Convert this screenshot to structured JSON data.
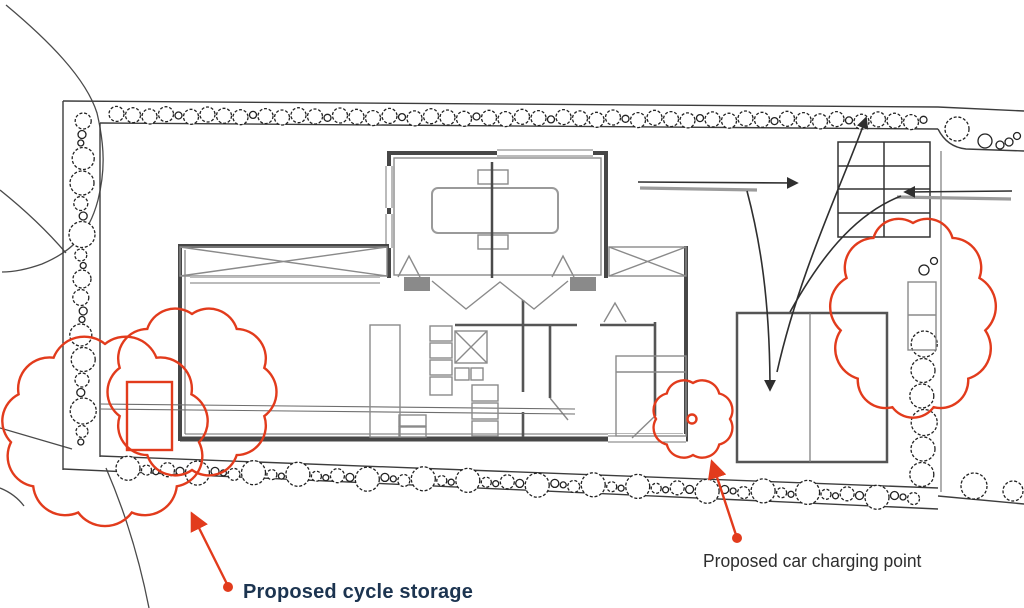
{
  "annotations": {
    "cycle_storage": {
      "label": "Proposed cycle storage"
    },
    "car_charging": {
      "label": "Proposed car charging point"
    }
  },
  "colors": {
    "annotation_red": "#e23b1c",
    "cycle_label_color": "#1c3450",
    "car_label_color": "#2e2e2e",
    "drawing_line": "#3d3d3d",
    "wall_gray": "#474747",
    "background": "#ffffff"
  }
}
